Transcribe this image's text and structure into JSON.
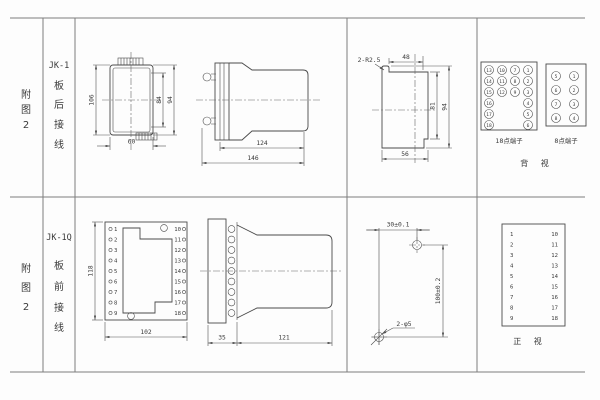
{
  "fig1": {
    "row_label": [
      "附",
      "图",
      "2"
    ],
    "model": "JK-1",
    "wiring": [
      "板",
      "后",
      "接",
      "线"
    ],
    "rear_view": {
      "h": "106",
      "ih": "84",
      "oh": "94",
      "w": "60"
    },
    "side_view": {
      "body": "124",
      "total": "146"
    },
    "cutout": {
      "r": "2-R2.5",
      "top": "48",
      "inner": "81",
      "h": "94",
      "bottom": "56"
    },
    "t18": {
      "caption": "18点端子",
      "c1": [
        "13",
        "14",
        "15",
        "16",
        "17",
        "18"
      ],
      "c2": [
        "10",
        "11",
        "12"
      ],
      "c3": [
        "7",
        "8",
        "9"
      ],
      "c4": [
        "1",
        "2",
        "3",
        "4",
        "5",
        "6"
      ]
    },
    "t8": {
      "caption": "8点端子",
      "left": [
        "5",
        "6",
        "7",
        "8"
      ],
      "right": [
        "1",
        "2",
        "3",
        "4"
      ]
    },
    "view": "背 视"
  },
  "fig2": {
    "row_label": [
      "附",
      "图",
      "2"
    ],
    "model": "JK-1Q",
    "wiring": [
      "板",
      "前",
      "接",
      "线"
    ],
    "front_view": {
      "h": "118",
      "w": "102",
      "left": [
        "1",
        "2",
        "3",
        "4",
        "5",
        "6",
        "7",
        "8",
        "9"
      ],
      "right": [
        "10",
        "11",
        "12",
        "13",
        "14",
        "15",
        "16",
        "17",
        "18"
      ]
    },
    "side_view": {
      "plate": "35",
      "body": "121"
    },
    "drill": {
      "h": "30±0.1",
      "v": "100±0.2",
      "hole": "2-φ5"
    },
    "pin_table": {
      "left": [
        "1",
        "2",
        "3",
        "4",
        "5",
        "6",
        "7",
        "8",
        "9"
      ],
      "right": [
        "10",
        "11",
        "12",
        "13",
        "14",
        "15",
        "16",
        "17",
        "18"
      ],
      "caption": "正 视"
    }
  }
}
